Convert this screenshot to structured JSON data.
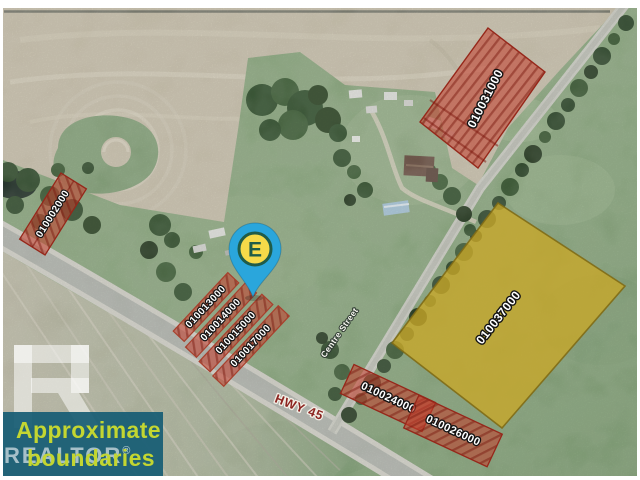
{
  "title": "Aerial parcel boundary map",
  "map": {
    "pin": {
      "label": "E"
    },
    "road_labels": {
      "highway": "HWY 45",
      "street": "Centre Street"
    },
    "parcels": [
      {
        "id": "010031000",
        "highlight": "red"
      },
      {
        "id": "010002000",
        "highlight": "red"
      },
      {
        "id": "010013000",
        "highlight": "red"
      },
      {
        "id": "010014000",
        "highlight": "red"
      },
      {
        "id": "010015000",
        "highlight": "red"
      },
      {
        "id": "010017000",
        "highlight": "red"
      },
      {
        "id": "010037000",
        "highlight": "yellow"
      },
      {
        "id": "010024000",
        "highlight": "red"
      },
      {
        "id": "010026000",
        "highlight": "red"
      }
    ]
  },
  "watermark": {
    "logo": "realtor-block-r",
    "line1": "Approximate",
    "line2": "boundaries",
    "brand": "REALTOR",
    "registered_mark": "®"
  },
  "colors": {
    "parcel_red": "#c43e2c",
    "parcel_yellow": "#c9a830",
    "pin_blue": "#2aa6dc",
    "pin_badge_yellow": "#f6da49",
    "pin_badge_green": "#1f5c49",
    "overlay_teal": "#175c74",
    "overlay_text": "#c3d631",
    "hwy_label_red": "#8c2420"
  }
}
